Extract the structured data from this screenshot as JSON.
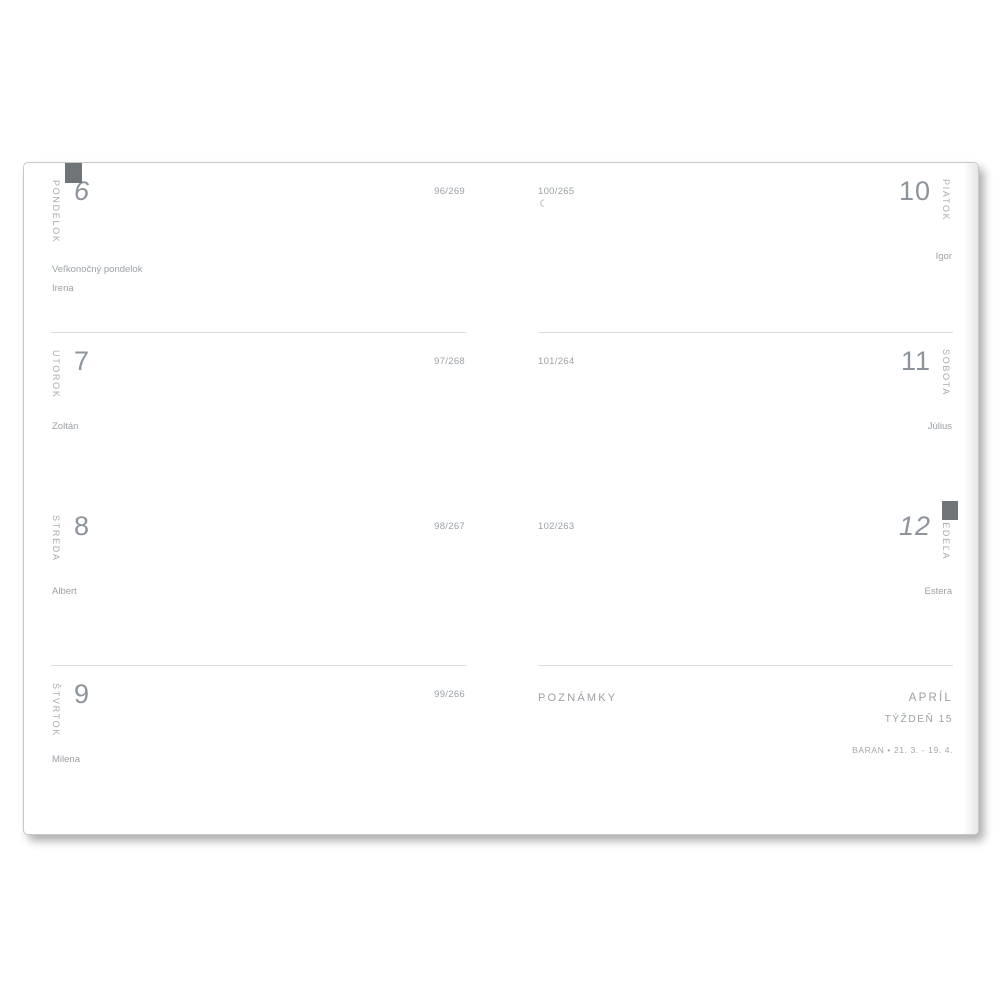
{
  "planner": {
    "days": {
      "monday": {
        "label": "PONDELOK",
        "number": "6",
        "day_of_year": "96/269",
        "holiday": "Veľkonočný pondelok",
        "name_day": "Irena"
      },
      "tuesday": {
        "label": "UTOROK",
        "number": "7",
        "day_of_year": "97/268",
        "name_day": "Zoltán"
      },
      "wednesday": {
        "label": "STREDA",
        "number": "8",
        "day_of_year": "98/267",
        "name_day": "Albert"
      },
      "thursday": {
        "label": "ŠTVRTOK",
        "number": "9",
        "day_of_year": "99/266",
        "name_day": "Milena"
      },
      "friday": {
        "label": "PIATOK",
        "number": "10",
        "day_of_year": "100/265",
        "moon_phase": "☾",
        "name_day": "Igor"
      },
      "saturday": {
        "label": "SOBOTA",
        "number": "11",
        "day_of_year": "101/264",
        "name_day": "Július"
      },
      "sunday": {
        "label": "NEDEĽA",
        "number": "12",
        "day_of_year": "102/263",
        "name_day": "Estera"
      }
    },
    "notes": {
      "label": "POZNÁMKY",
      "month": "APRÍL",
      "week": "TÝŽDEŇ 15",
      "zodiac": "BARAN • 21. 3. - 19. 4."
    },
    "colors": {
      "tab": "#6f7478",
      "muted_text": "#9ba1a6",
      "day_number": "#8d949b",
      "hairline": "#dadcdd",
      "page_border": "#c6c8ca"
    },
    "icons": {
      "moon_phase_icon": "☾"
    }
  }
}
